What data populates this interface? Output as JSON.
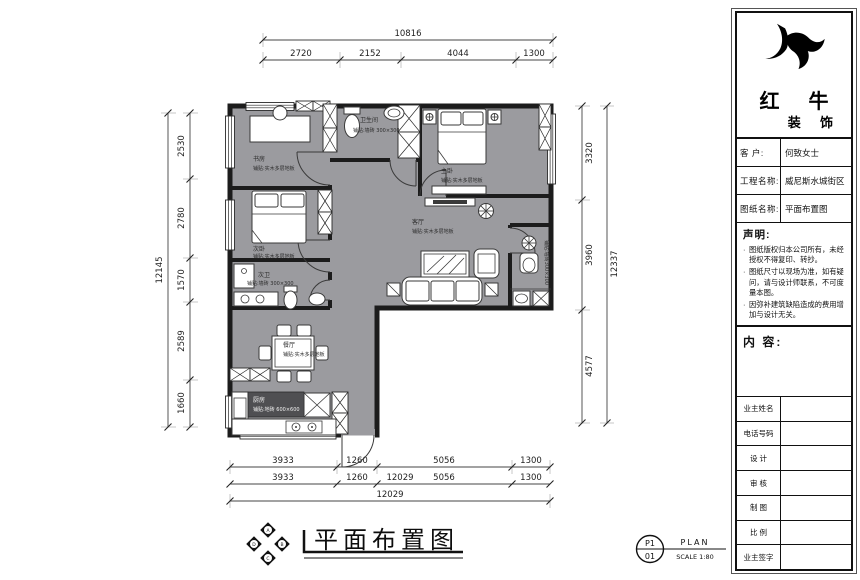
{
  "drawing": {
    "title": "平面布置图",
    "compass": {
      "top": "A",
      "right": "B",
      "bottom": "C",
      "left": "D"
    },
    "sheet": {
      "code_top": "P1",
      "code_bottom": "01",
      "label": "PLAN",
      "scale": "SCALE 1:80"
    }
  },
  "dims": {
    "top": {
      "total": "10816",
      "seg1": "2720",
      "seg2": "2152",
      "seg3": "4044",
      "seg4": "1300"
    },
    "left": {
      "total": "12145",
      "seg1": "2530",
      "seg2": "2780",
      "seg3": "1570",
      "seg4": "2589",
      "seg5": "1660"
    },
    "right": {
      "total": "12337",
      "seg1": "3320",
      "seg2": "3960",
      "seg3": "4577"
    },
    "bottom": {
      "row1": [
        "3933",
        "1260",
        "5056",
        "1300"
      ],
      "row2": [
        "3933",
        "1260",
        "12029",
        "5056",
        "1300"
      ],
      "total": "12029"
    }
  },
  "rooms": {
    "study": {
      "name": "书房",
      "floor": "铺贴:实木多层地板"
    },
    "bath_top": {
      "name": "卫生间",
      "floor": "铺贴:墙砖 300×300"
    },
    "master": {
      "name": "主卧",
      "floor": "铺贴:实木多层地板"
    },
    "second": {
      "name": "次卧",
      "floor": "铺贴:实木多层地板"
    },
    "second_bath": {
      "name": "次卫",
      "floor": "铺贴:墙砖 300×300"
    },
    "living": {
      "name": "客厅",
      "floor": "铺贴:实木多层地板"
    },
    "dining": {
      "name": "餐厅",
      "floor": "铺贴:实木多层地板"
    },
    "kitchen": {
      "name": "厨房",
      "floor": "铺贴:地砖 600×600"
    },
    "bath_right": {
      "floor": "铺贴:墙砖300×300"
    }
  },
  "titleblock": {
    "brand": {
      "line1": "红 牛",
      "line2": "装 饰"
    },
    "fields": [
      {
        "label": "客  户:",
        "value": "何致女士"
      },
      {
        "label": "工程名称:",
        "value": "威尼斯水城街区"
      },
      {
        "label": "图纸名称:",
        "value": "平面布置图"
      }
    ],
    "statement": {
      "heading": "声明:",
      "items": [
        "图纸版权归本公司所有，未经授权不得复印、转抄。",
        "图纸尺寸以现场为准，如有疑问，请与设计师联系，不可度量本图。",
        "因弥补建筑缺陷造成的费用增加与设计无关。"
      ]
    },
    "content_heading": "内 容:",
    "sign_rows": [
      "业主姓名",
      "电话号码",
      "设 计",
      "审 核",
      "制 图",
      "比 例",
      "业主签字"
    ]
  },
  "colors": {
    "floor": "#9b9b9f",
    "wall": "#1c1c1c",
    "counter_dark": "#4f4f52",
    "ink": "#111111"
  }
}
